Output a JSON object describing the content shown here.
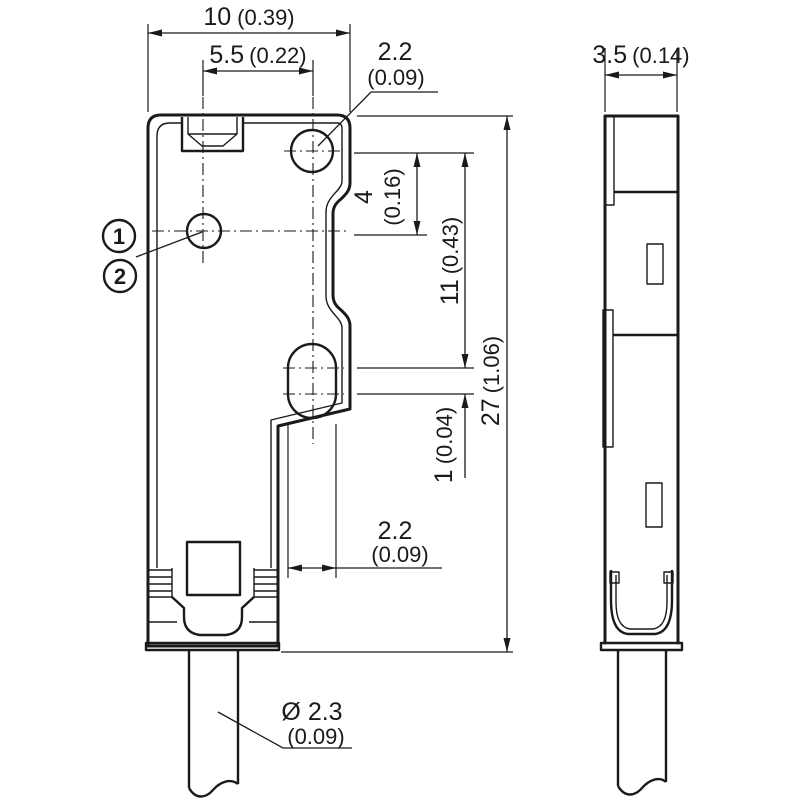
{
  "colors": {
    "line": "#1a1a1a",
    "background": "#ffffff"
  },
  "callouts": {
    "one": "1",
    "two": "2"
  },
  "dimensions": {
    "outer_width": {
      "value": "10",
      "inch": "(0.39)"
    },
    "hole_spacing": {
      "value": "5.5",
      "inch": "(0.22)"
    },
    "top_hole_dia": {
      "value": "2.2",
      "inch": "(0.09)"
    },
    "hole_offset": {
      "value": "4",
      "inch": "(0.16)"
    },
    "hole_to_slot": {
      "value": "11",
      "inch": "(0.43)"
    },
    "body_length": {
      "value": "27",
      "inch": "(1.06)"
    },
    "slot_play": {
      "value": "1",
      "inch": "(0.04)"
    },
    "slot_width": {
      "value": "2.2",
      "inch": "(0.09)"
    },
    "cable_dia": {
      "value": "Ø 2.3",
      "inch": "(0.09)"
    },
    "side_width": {
      "value": "3.5",
      "inch": "(0.14)"
    }
  }
}
